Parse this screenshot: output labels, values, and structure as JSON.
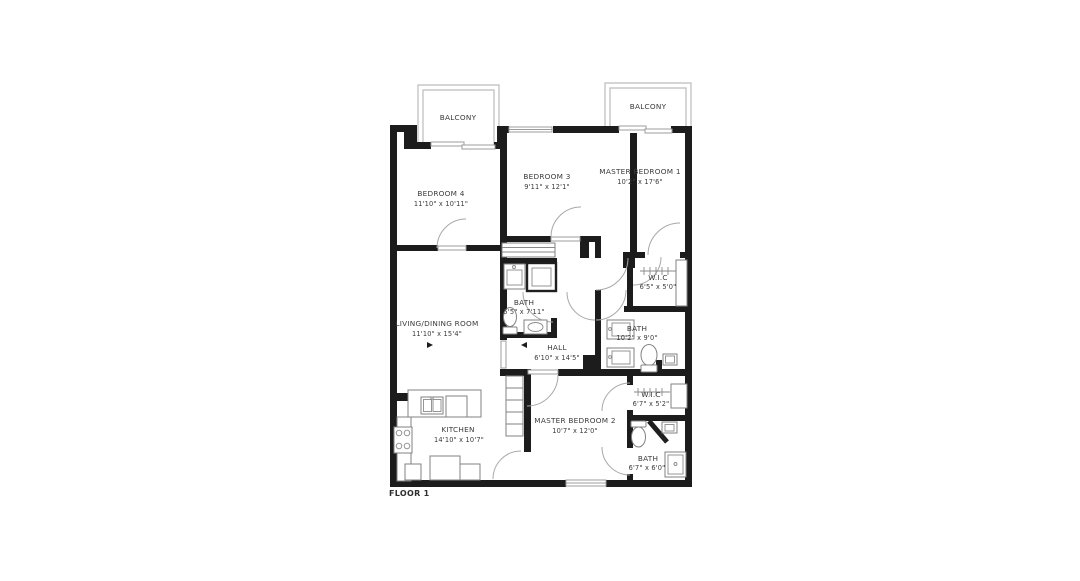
{
  "plan": {
    "floor_label": "FLOOR 1",
    "colors": {
      "background": "#ffffff",
      "wall": "#1c1c1c",
      "thin_line": "#9c9c9c",
      "balcony_line": "#bcbcbc",
      "fixture_line": "#828282",
      "label_text": "#3a3a3a"
    },
    "rooms": {
      "balcony_left": {
        "name": "BALCONY"
      },
      "balcony_right": {
        "name": "BALCONY"
      },
      "bedroom4": {
        "name": "BEDROOM 4",
        "dims": "11'10\" x 10'11\""
      },
      "bedroom3": {
        "name": "BEDROOM 3",
        "dims": "9'11\" x 12'1\""
      },
      "master_bedroom1": {
        "name": "MASTER BEDROOM 1",
        "dims": "10'2\" x 17'6\""
      },
      "living_dining": {
        "name": "LIVING/DINING ROOM",
        "dims": "11'10\" x 15'4\""
      },
      "bath1": {
        "name": "BATH",
        "dims": "5'5\" x 7'11\""
      },
      "hall": {
        "name": "HALL",
        "dims": "6'10\" x 14'5\""
      },
      "wic1": {
        "name": "W.I.C",
        "dims": "6'5\" x 5'0\""
      },
      "bath2": {
        "name": "BATH",
        "dims": "10'2\" x 9'0\""
      },
      "wic2": {
        "name": "W.I.C",
        "dims": "6'7\" x 5'2\""
      },
      "master_bedroom2": {
        "name": "MASTER BEDROOM 2",
        "dims": "10'7\" x 12'0\""
      },
      "kitchen": {
        "name": "KITCHEN",
        "dims": "14'10\" x 10'7\""
      },
      "bath3": {
        "name": "BATH",
        "dims": "6'7\" x 6'0\""
      }
    }
  }
}
